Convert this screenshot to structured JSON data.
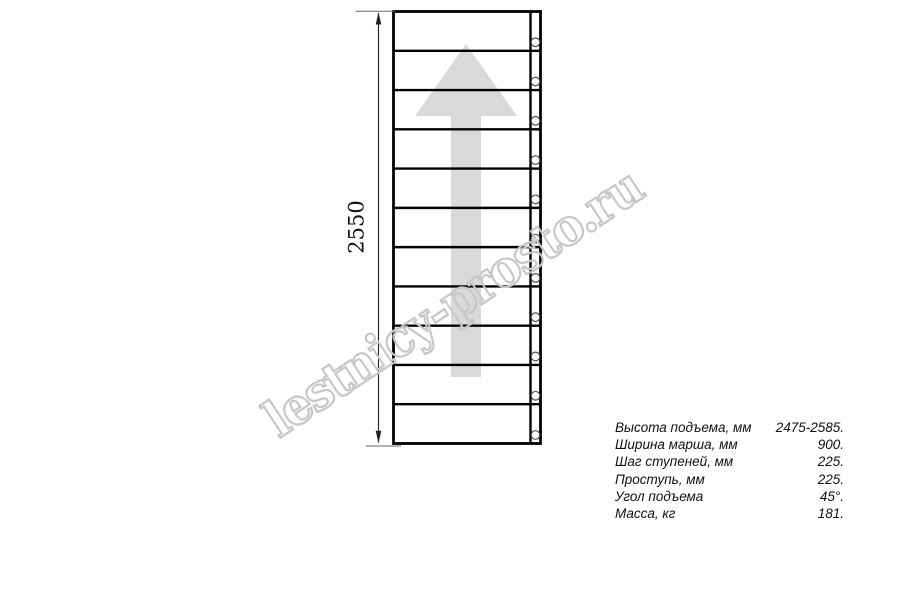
{
  "page": {
    "background": "#ffffff"
  },
  "drawing": {
    "name": "straight-staircase-plan-view",
    "dimension_label": "2550",
    "step_count": 11,
    "arrow_direction": "up",
    "line_color": "#000000",
    "thin_line_color": "#6b6b6b",
    "arrow_color": "#d9d9d9",
    "bolt_stroke_color": "#4d4d4d"
  },
  "watermark": {
    "text": "lestnicy-prosto.ru",
    "color": "#c7c7c7"
  },
  "specs": {
    "rows": [
      {
        "label": "Высота подъема, мм",
        "value": "2475-2585."
      },
      {
        "label": "Ширина марша, мм",
        "value": "900."
      },
      {
        "label": "Шаг ступеней, мм",
        "value": "225."
      },
      {
        "label": "Проступь, мм",
        "value": "225."
      },
      {
        "label": "Угол подъема",
        "value": "45°."
      },
      {
        "label": "Масса, кг",
        "value": "181."
      }
    ]
  }
}
